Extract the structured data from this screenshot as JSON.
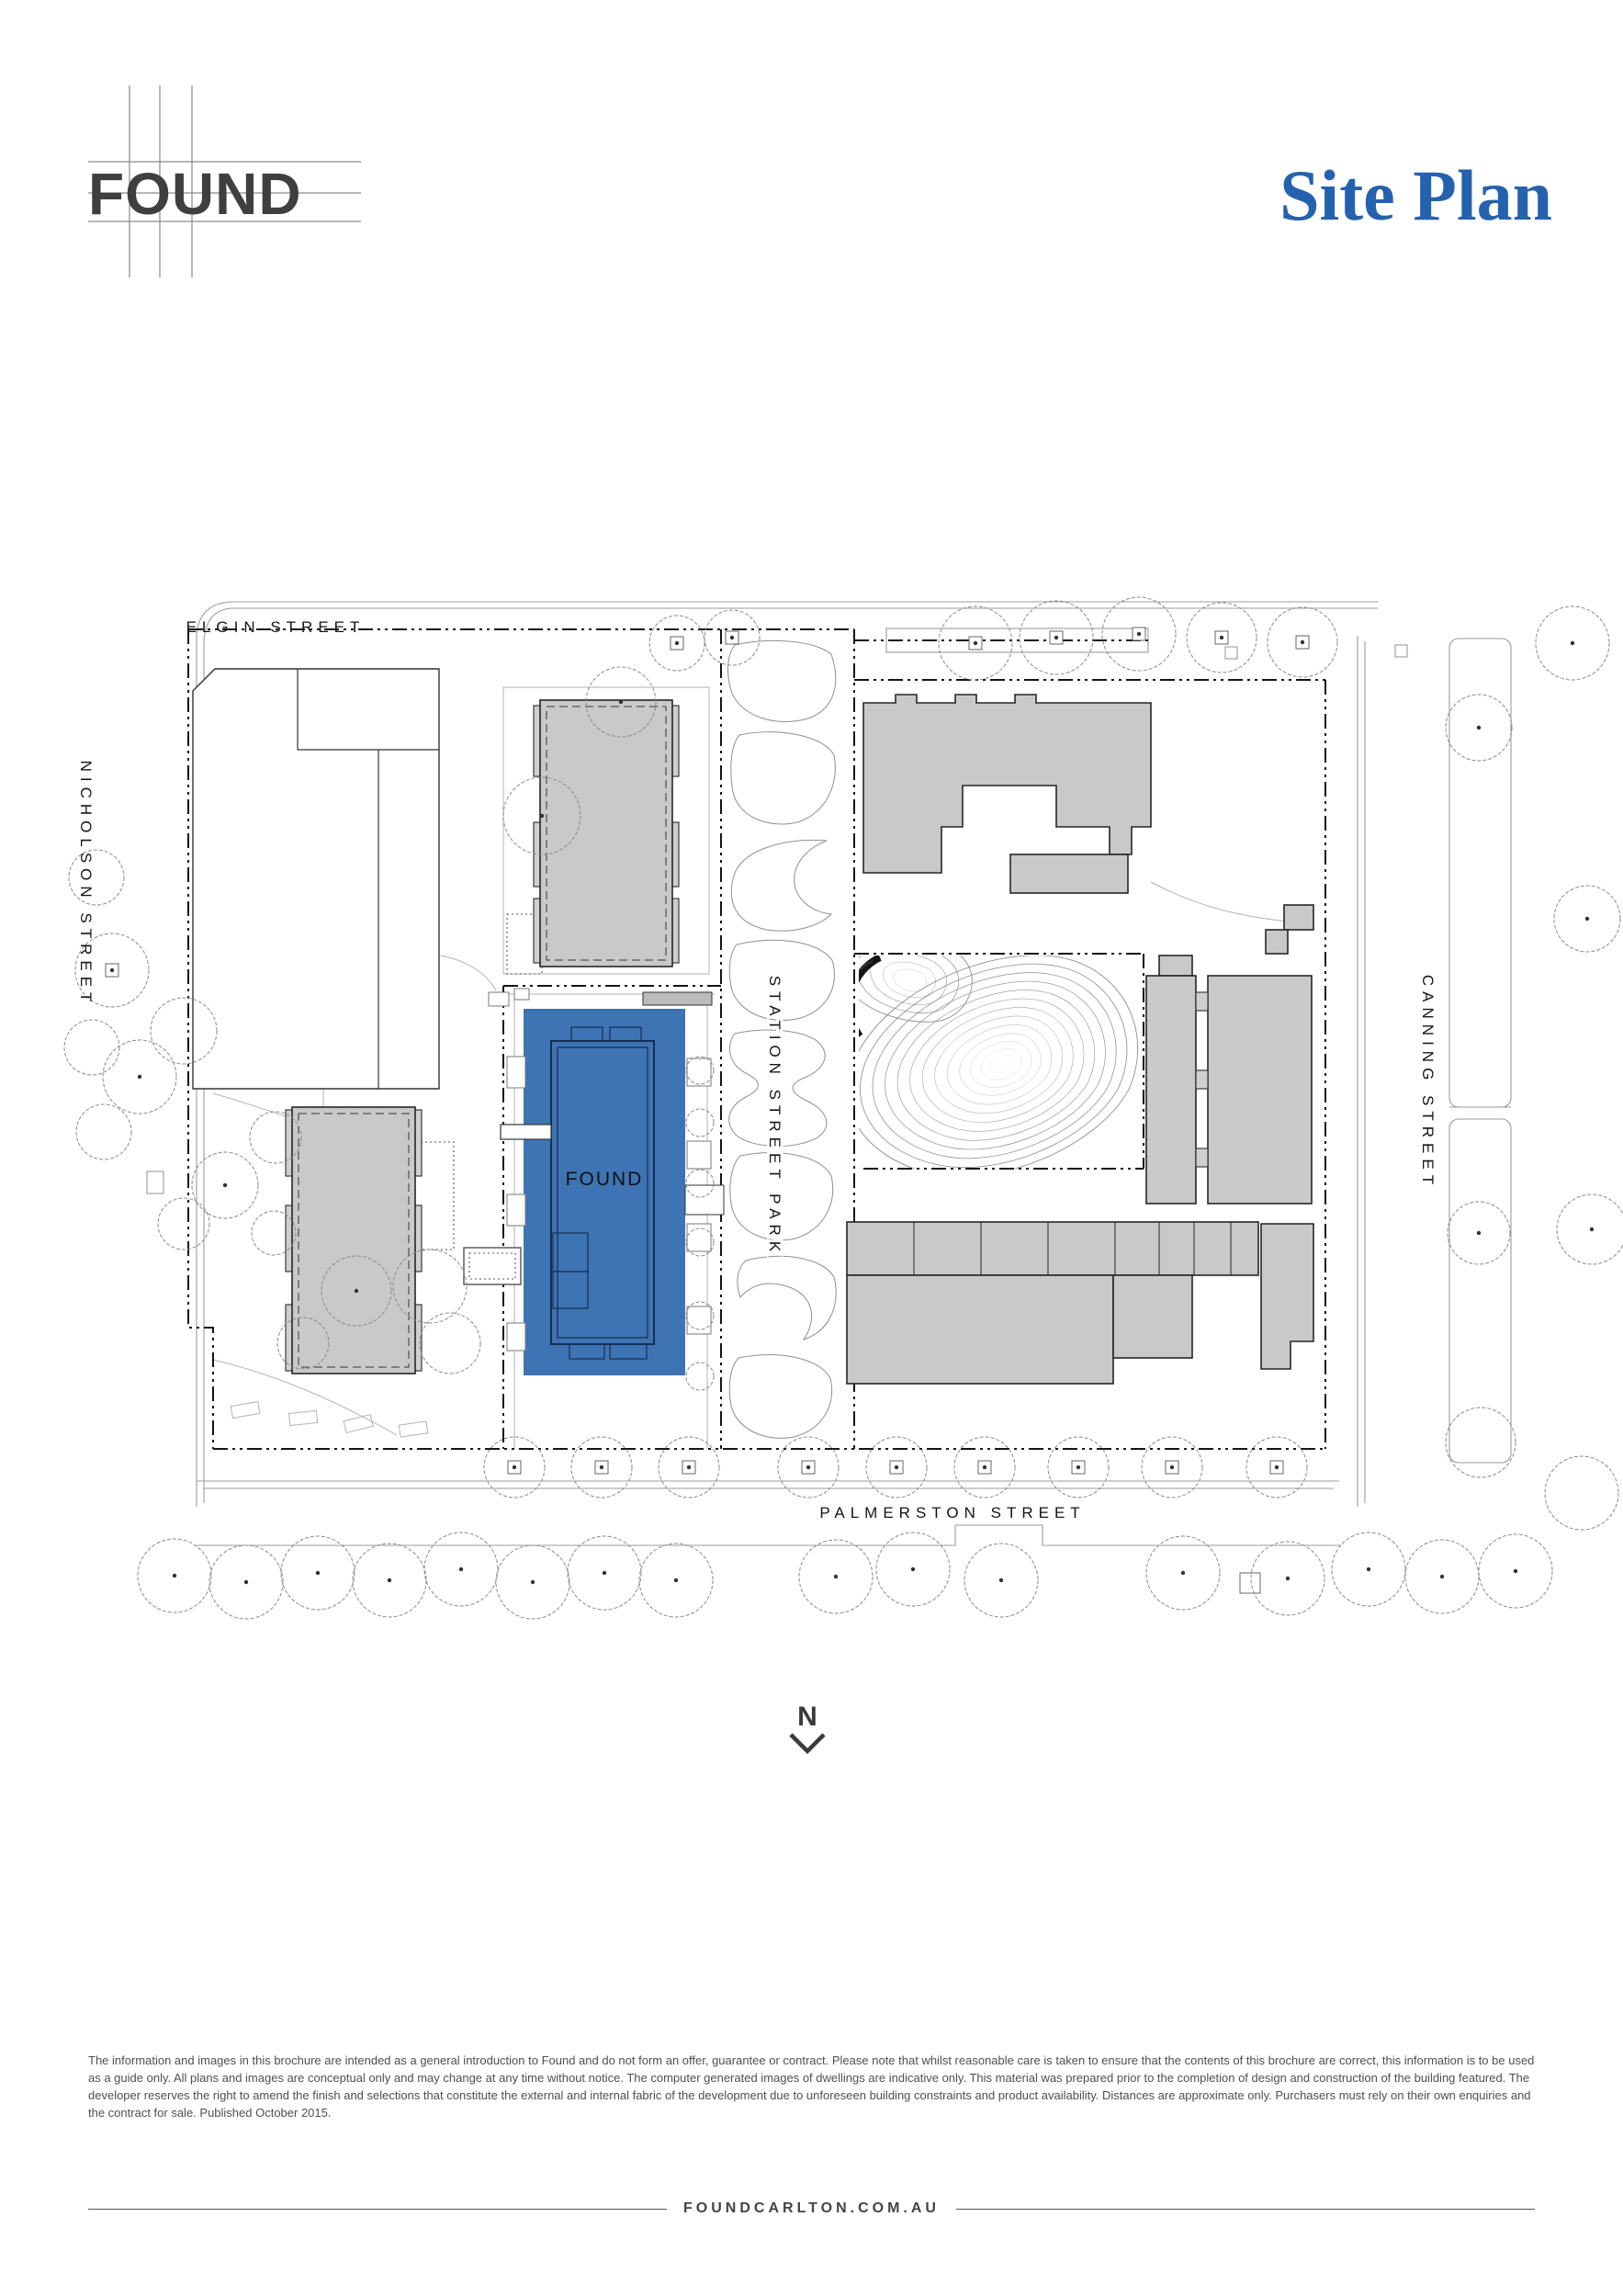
{
  "page": {
    "brand": "FOUND",
    "title": "Site Plan",
    "footer_url": "FOUNDCARLTON.COM.AU",
    "disclaimer": "The information and images in this brochure are intended as a general introduction to Found and do not form an offer, guarantee or contract. Please note that whilst reasonable care is taken to ensure that the contents of this brochure are correct, this information is to be used as a guide only. All plans and images are conceptual only and may change at any time without notice. The computer generated images of dwellings are indicative only. This material was prepared prior to the completion of design and construction of the building featured. The developer reserves the right to amend the finish and selections that constitute the external and internal fabric of the development due to unforeseen building constraints and product availability. Distances are approximate only. Purchasers must rely on their own enquiries and the contract for sale. Published October 2015."
  },
  "plan": {
    "streets": {
      "top": "ELGIN STREET",
      "left": "NICHOLSON STREET",
      "center": "STATION STREET PARK",
      "right": "CANNING STREET",
      "bottom": "PALMERSTON STREET"
    },
    "building_label": "FOUND",
    "north_label": "N"
  },
  "colors": {
    "accent_blue": "#2562AE",
    "building_blue": "#3E74B4"
  }
}
